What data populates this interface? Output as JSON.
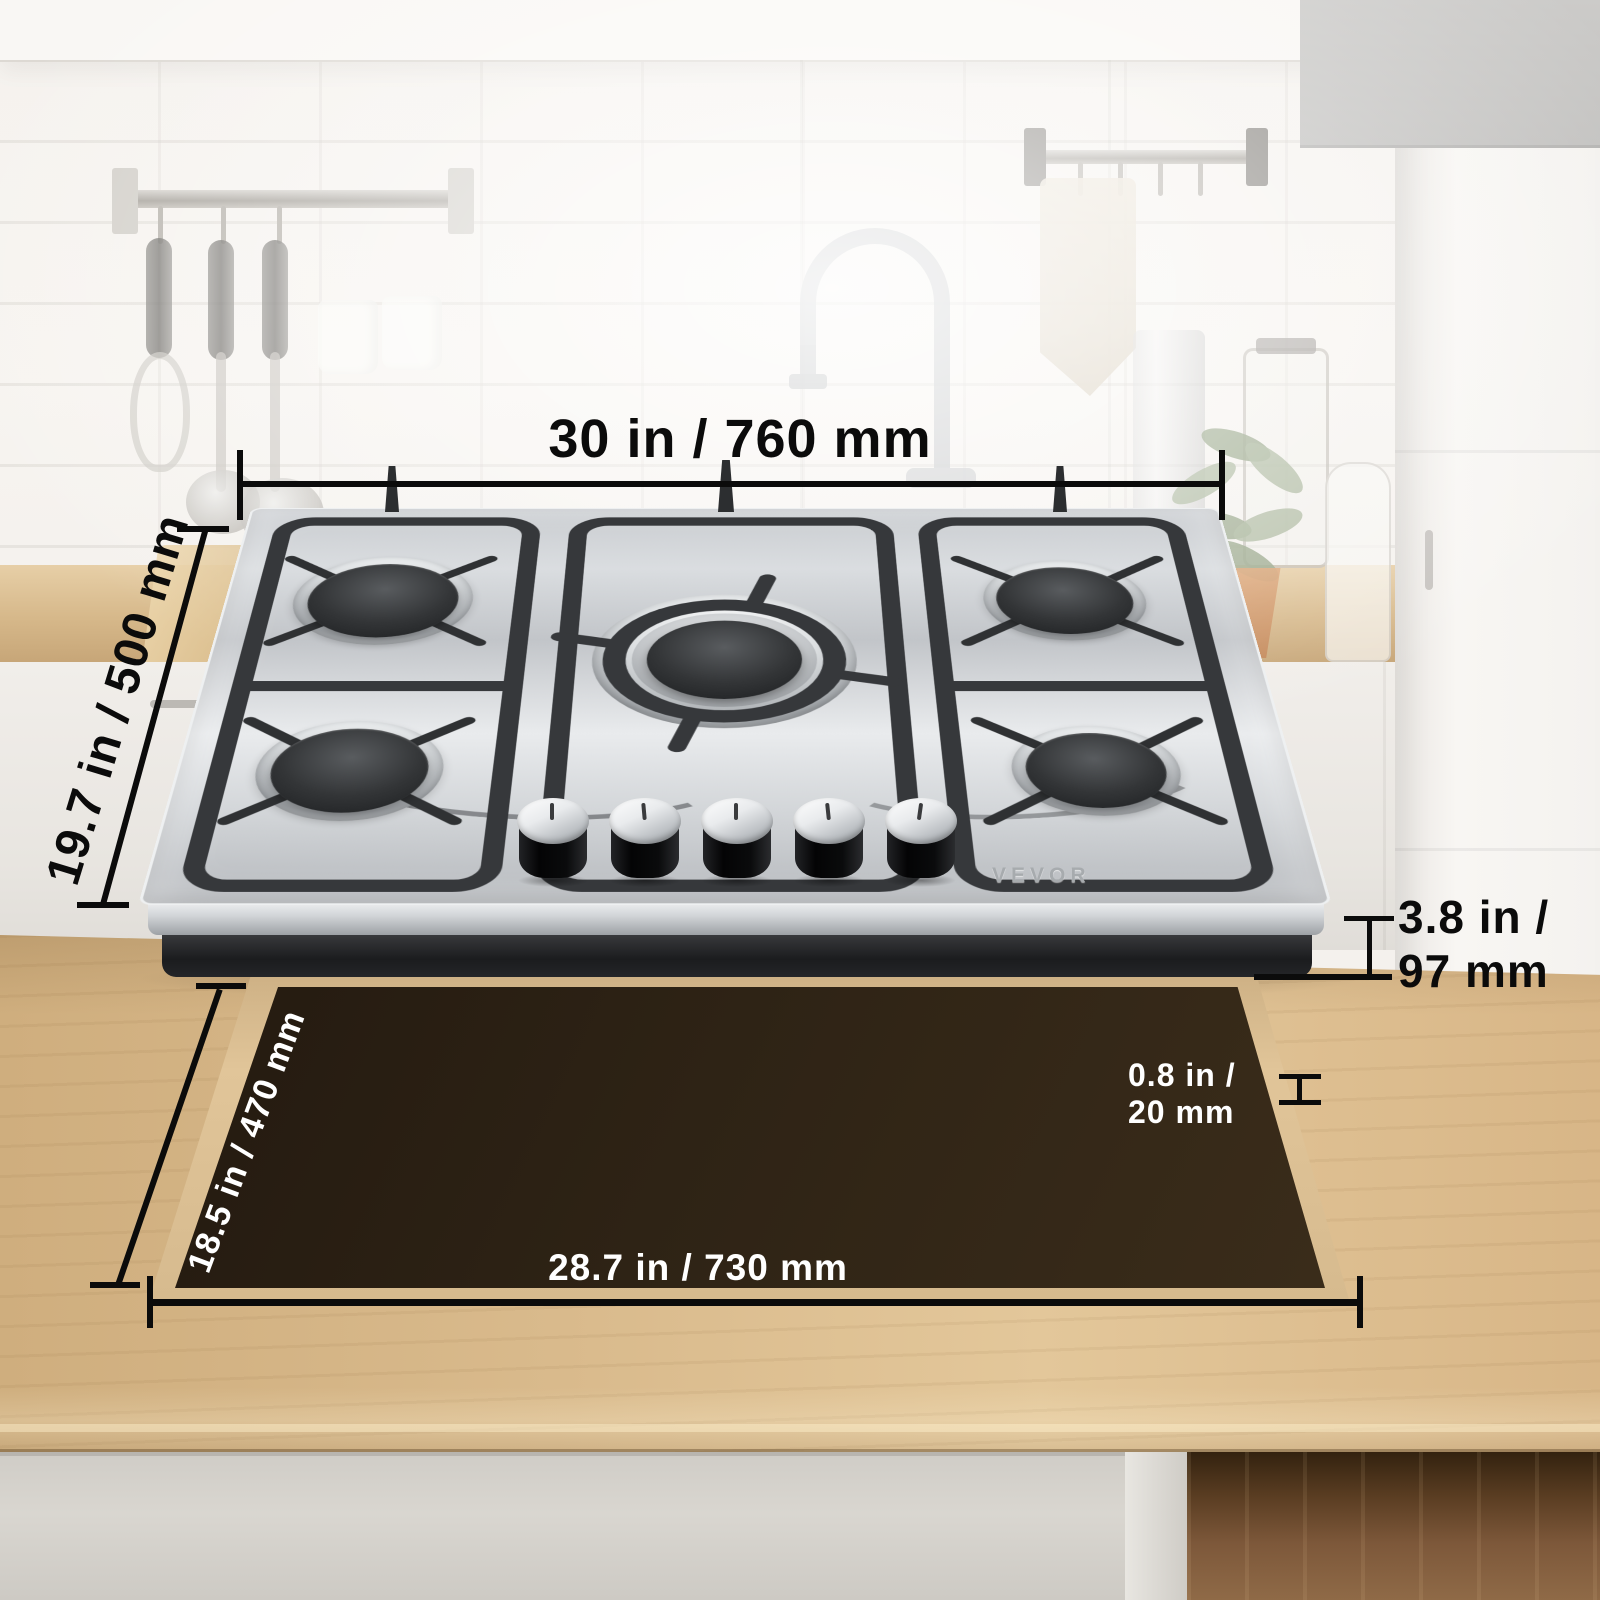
{
  "brand": "VEVOR",
  "annotations": {
    "cooktop_width": "30 in / 760 mm",
    "cooktop_depth": "19.7 in / 500 mm",
    "cooktop_height": {
      "line1": "3.8 in /",
      "line2": "97 mm"
    },
    "cutout_depth": "18.5 in / 470 mm",
    "cutout_width": "28.7 in / 730 mm",
    "countertop_thickness": {
      "line1": "0.8 in /",
      "line2": "20 mm"
    }
  },
  "colors": {
    "dimension_line": "#0b0b0b",
    "label_dark": "#0b0b0b",
    "label_light": "#ffffff",
    "cutout_hole": "#2e2315",
    "countertop_wood": "#d9ba8c",
    "stainless_steel": "#d6d8da",
    "grate_black": "#36383b"
  }
}
